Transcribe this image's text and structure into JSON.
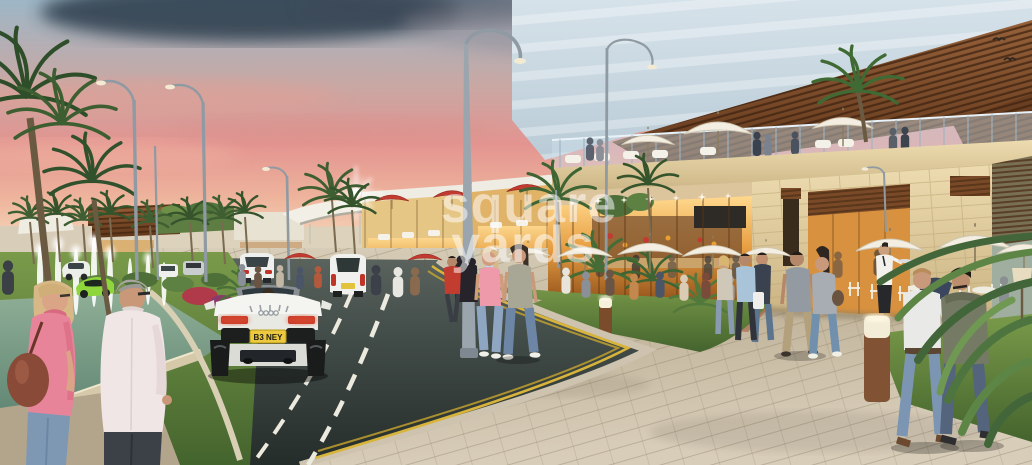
{
  "scene": {
    "type": "architectural rendering",
    "setting": "Mixed-use retail boulevard at dusk: cafe terraces, rooftop lounge, fountain median, pedestrians and a white convertible sports car"
  },
  "watermark": {
    "line1": "square",
    "line2": "yards"
  },
  "license_plate": {
    "text": "B3 NEY"
  },
  "palette": {
    "sky_top": "#9db6c6",
    "sky_pink": "#e89d90",
    "sky_horizon": "#f6dfc2",
    "cloud_dark": "#2c3a49",
    "glass_tower": "#ccdbe4",
    "pergola_wood": "#7d4e2d",
    "stone": "#e3d3a8",
    "storefront_glow": "#eda94e",
    "road_asphalt": "#3d4744",
    "lane_yellow": "#d8b43a",
    "plaza_paver": "#cec3ad",
    "grass": "#5d7d42",
    "palm_green": "#3f5f33",
    "umbrella_white": "#f3eee1",
    "umbrella_red": "#c23b30",
    "car_white": "#f2f2ee",
    "taillight_red": "#c43425",
    "pool_water": "#7fa18c",
    "watermark_white": "#ffffff"
  }
}
